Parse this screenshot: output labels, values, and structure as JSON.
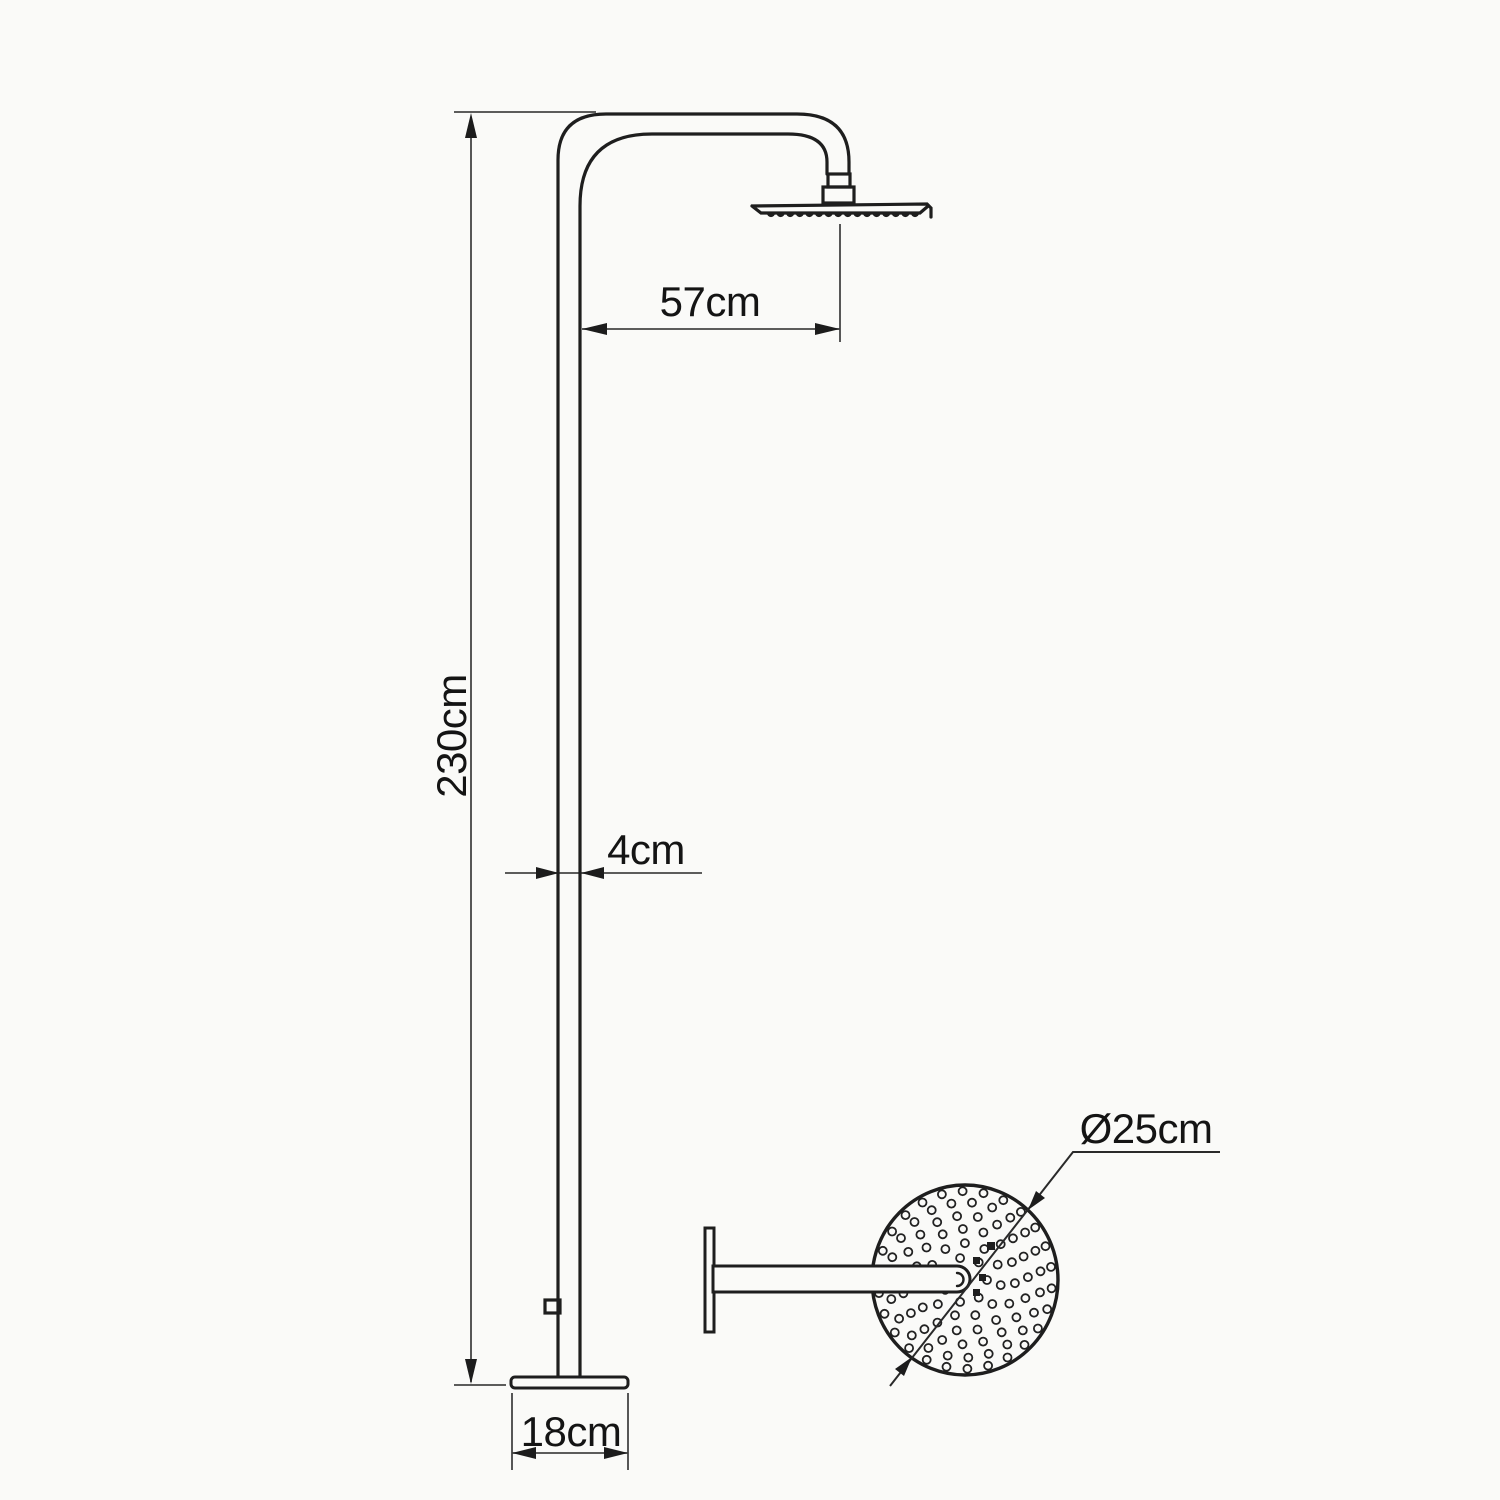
{
  "figure": {
    "type": "technical-drawing",
    "views": [
      "side-elevation",
      "shower-head-top-view"
    ]
  },
  "colors": {
    "background": "#fafaf8",
    "product_line": "#1e1e1e",
    "dimension_line": "#454545",
    "text": "#141414"
  },
  "labels": {
    "arm_reach": "57cm",
    "column_height": "230cm",
    "pipe_width": "4cm",
    "base_plate_width": "18cm",
    "head_diameter": "Ø25cm"
  },
  "head_top_view": {
    "center_x": 965,
    "center_y": 1280,
    "radius_x": 93,
    "radius_y": 95,
    "dot_radius": 4,
    "rings": [
      {
        "radius": 22,
        "count": 7
      },
      {
        "radius": 36,
        "count": 11
      },
      {
        "radius": 50,
        "count": 15
      },
      {
        "radius": 63,
        "count": 19
      },
      {
        "radius": 76,
        "count": 23
      },
      {
        "radius": 87,
        "count": 26
      }
    ]
  },
  "head_side_view": {
    "teeth": {
      "count": 16,
      "start_x": 771,
      "end_x": 915,
      "y": 213,
      "radius": 4.1
    }
  }
}
